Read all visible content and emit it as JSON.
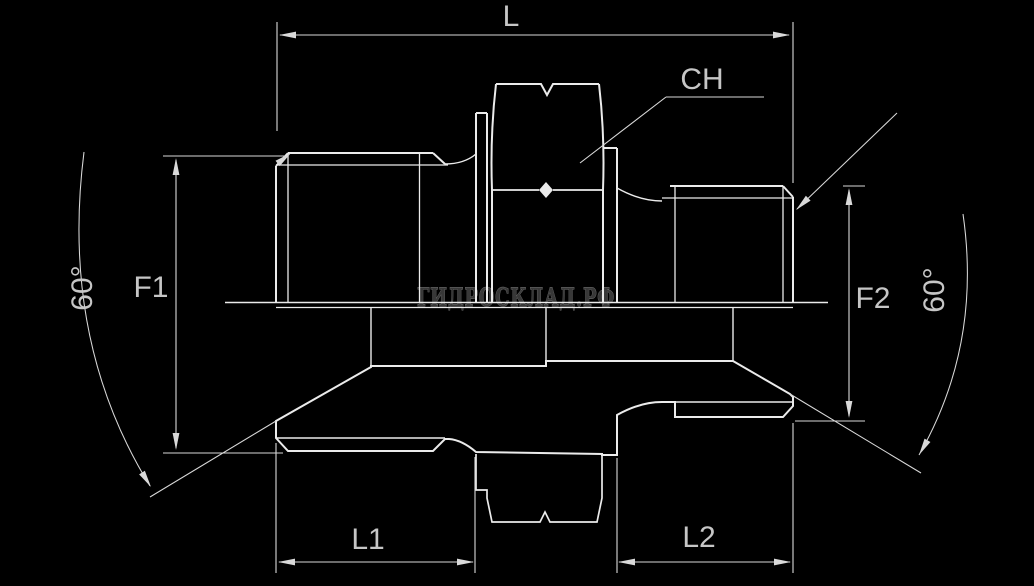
{
  "drawing": {
    "kind": "technical-drawing-hydraulic-adapter-fitting",
    "labels": {
      "overall_length": "L",
      "wrench_size": "CH",
      "thread_left": "F1",
      "thread_right": "F2",
      "angle_left": "60°",
      "angle_right": "60°",
      "length_left": "L1",
      "length_right": "L2"
    },
    "watermark": {
      "text": "ГИДРОСКЛАД.РФ"
    },
    "colors": {
      "background": "#000000",
      "outline": "#ebebeb",
      "dimension": "#d9d9d9",
      "hatch": "#d9d9d9",
      "label_text": "#c6c6c6",
      "watermark_fill": "#383838",
      "watermark_stroke": "#6f6f6f"
    }
  }
}
